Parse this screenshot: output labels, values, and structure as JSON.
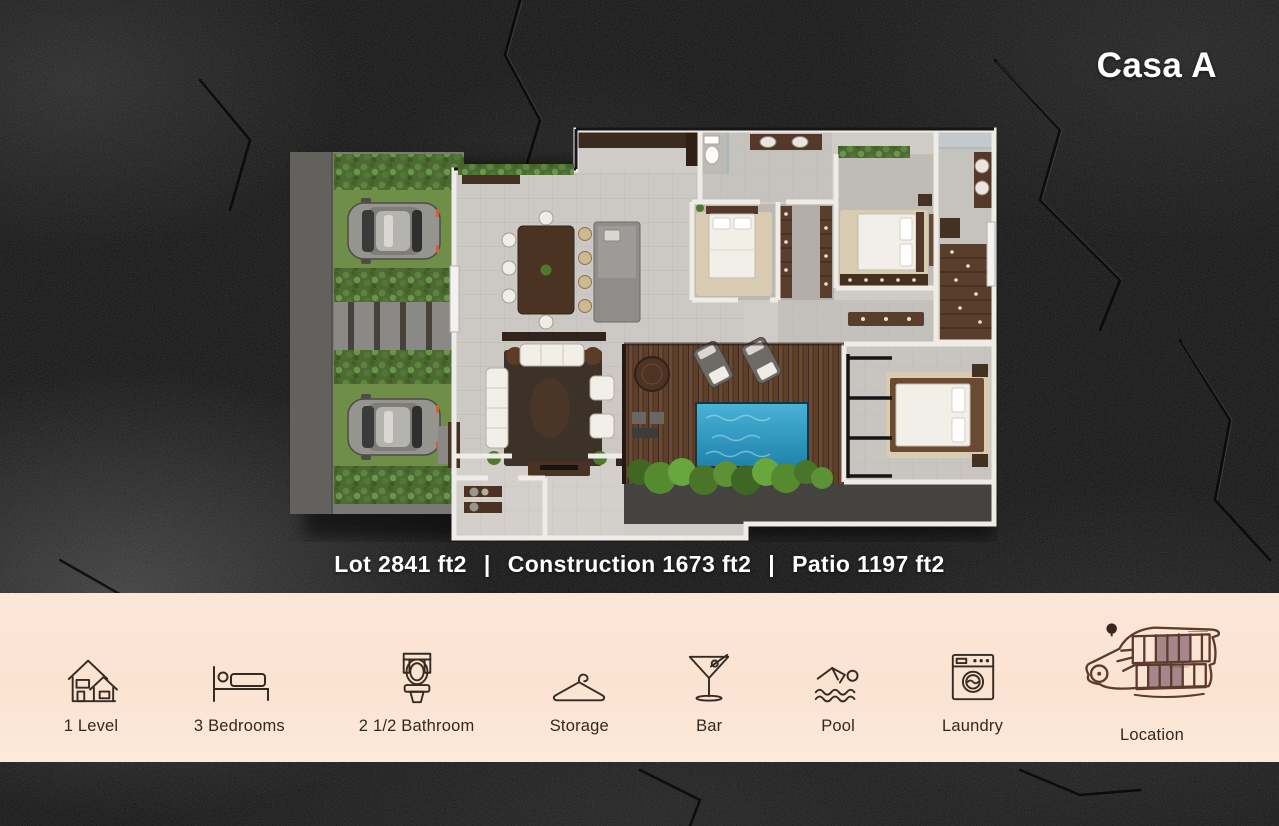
{
  "title": "Casa A",
  "stats": {
    "separator": "|",
    "items": [
      {
        "label": "Lot 2841 ft2"
      },
      {
        "label": "Construction 1673 ft2"
      },
      {
        "label": "Patio 1197 ft2"
      }
    ]
  },
  "features": {
    "items": [
      {
        "label": "1 Level",
        "icon": "house-icon"
      },
      {
        "label": "3 Bedrooms",
        "icon": "bed-icon"
      },
      {
        "label": "2 1/2 Bathroom",
        "icon": "toilet-icon"
      },
      {
        "label": "Storage",
        "icon": "hanger-icon"
      },
      {
        "label": "Bar",
        "icon": "martini-icon"
      },
      {
        "label": "Pool",
        "icon": "swimmer-icon"
      },
      {
        "label": "Laundry",
        "icon": "washing-machine-icon"
      },
      {
        "label": "Location",
        "icon": "site-map-icon"
      }
    ]
  },
  "colors": {
    "background": "#141414",
    "panel_bg": "#fbe4d4",
    "title_text": "#ffffff",
    "stats_text": "#ffffff",
    "label_text": "#33291f",
    "icon_stroke": "#362b22",
    "map_outline": "#5d3a2b",
    "map_lot_highlight": "#a5878b",
    "pool_water": "#2f9fc7",
    "hedge_green": "#4c6a32",
    "deck_wood": "#6b4832"
  }
}
